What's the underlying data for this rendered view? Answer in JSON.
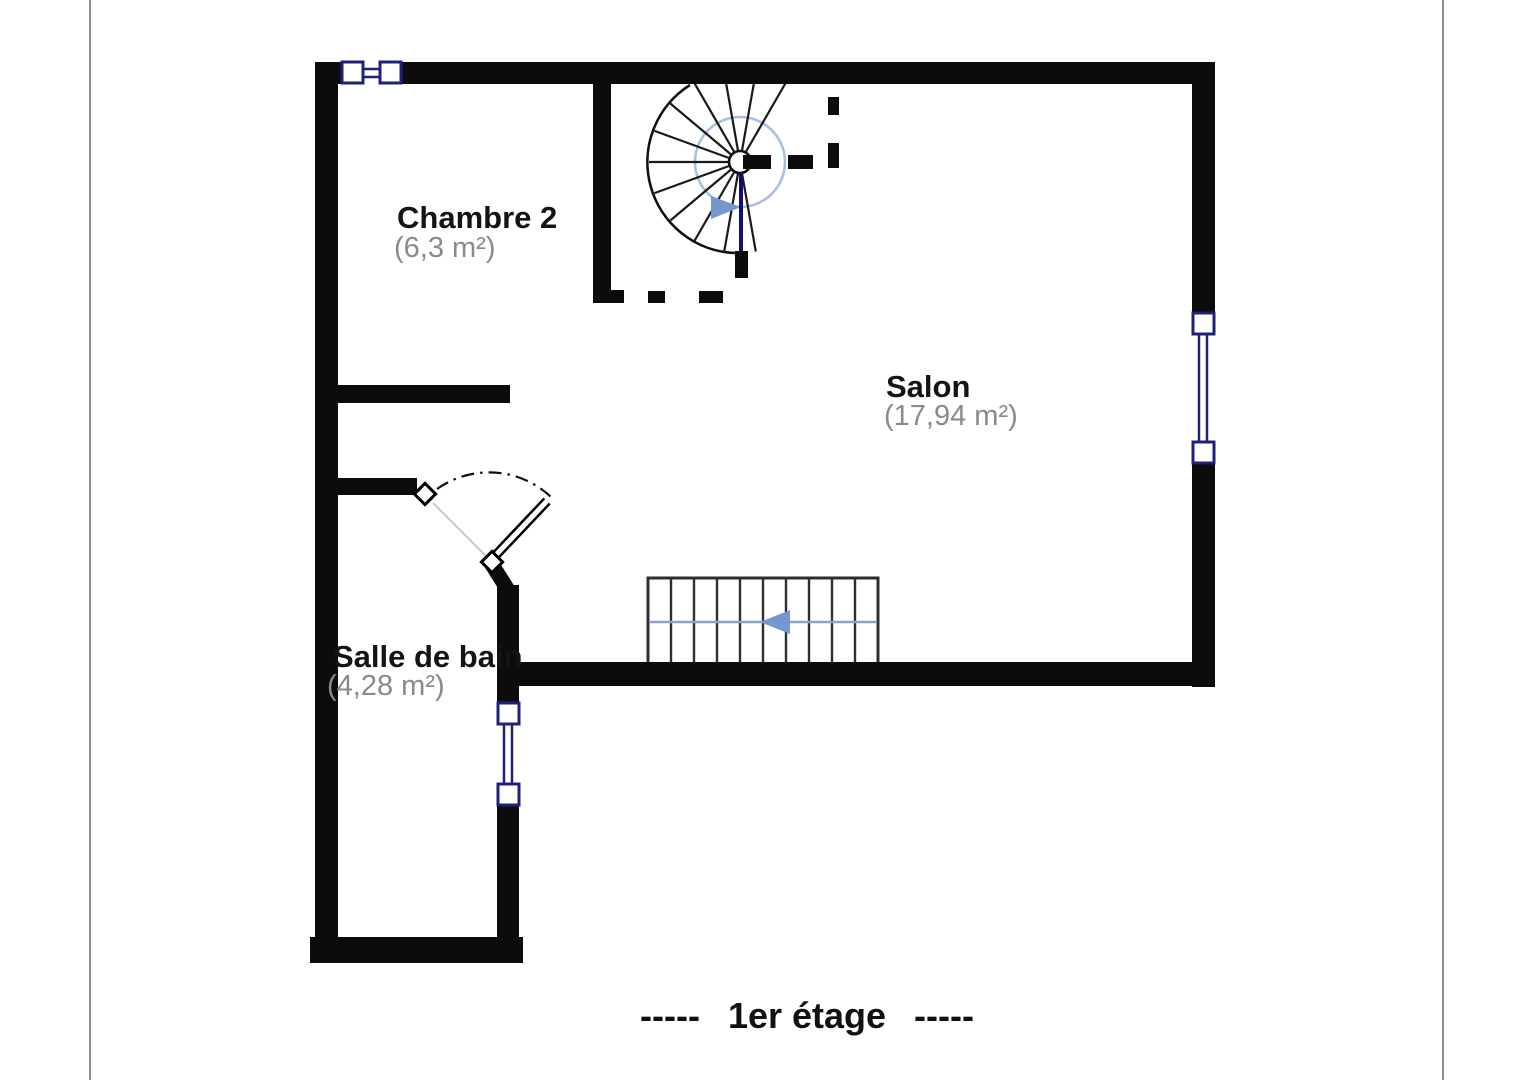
{
  "page": {
    "kind": "floor plan document page"
  },
  "floor_plan": {
    "rooms": [
      {
        "name": "Chambre 2",
        "area": "(6,3 m²)"
      },
      {
        "name": "Salon",
        "area": "(17,94 m²)"
      },
      {
        "name": "Salle de bain",
        "area": "(4,28 m²)"
      }
    ],
    "caption": {
      "dashes_left": "-----",
      "title": "1er étage",
      "dashes_right": "-----"
    },
    "symbols": [
      "spiral-staircase-icon (with blue direction arrow)",
      "straight-staircase-icon (10 treads, blue left arrow)",
      "door-swing-icon (bathroom entry)",
      "window-icon (top wall)",
      "window-icon (right wall)",
      "window-icon (bathroom wall)"
    ]
  },
  "colors": {
    "wall": "#0c0c0c",
    "room-name": "#141414",
    "room-area": "#8a8a8a",
    "window-frame": "#20207a",
    "stair-blue": "#a9bfde",
    "stair-line-blue": "#8aa4c8",
    "arrow-blue": "#7597cf",
    "stair-outline": "#2f2f2f",
    "page-edge": "#8f8f8f"
  }
}
